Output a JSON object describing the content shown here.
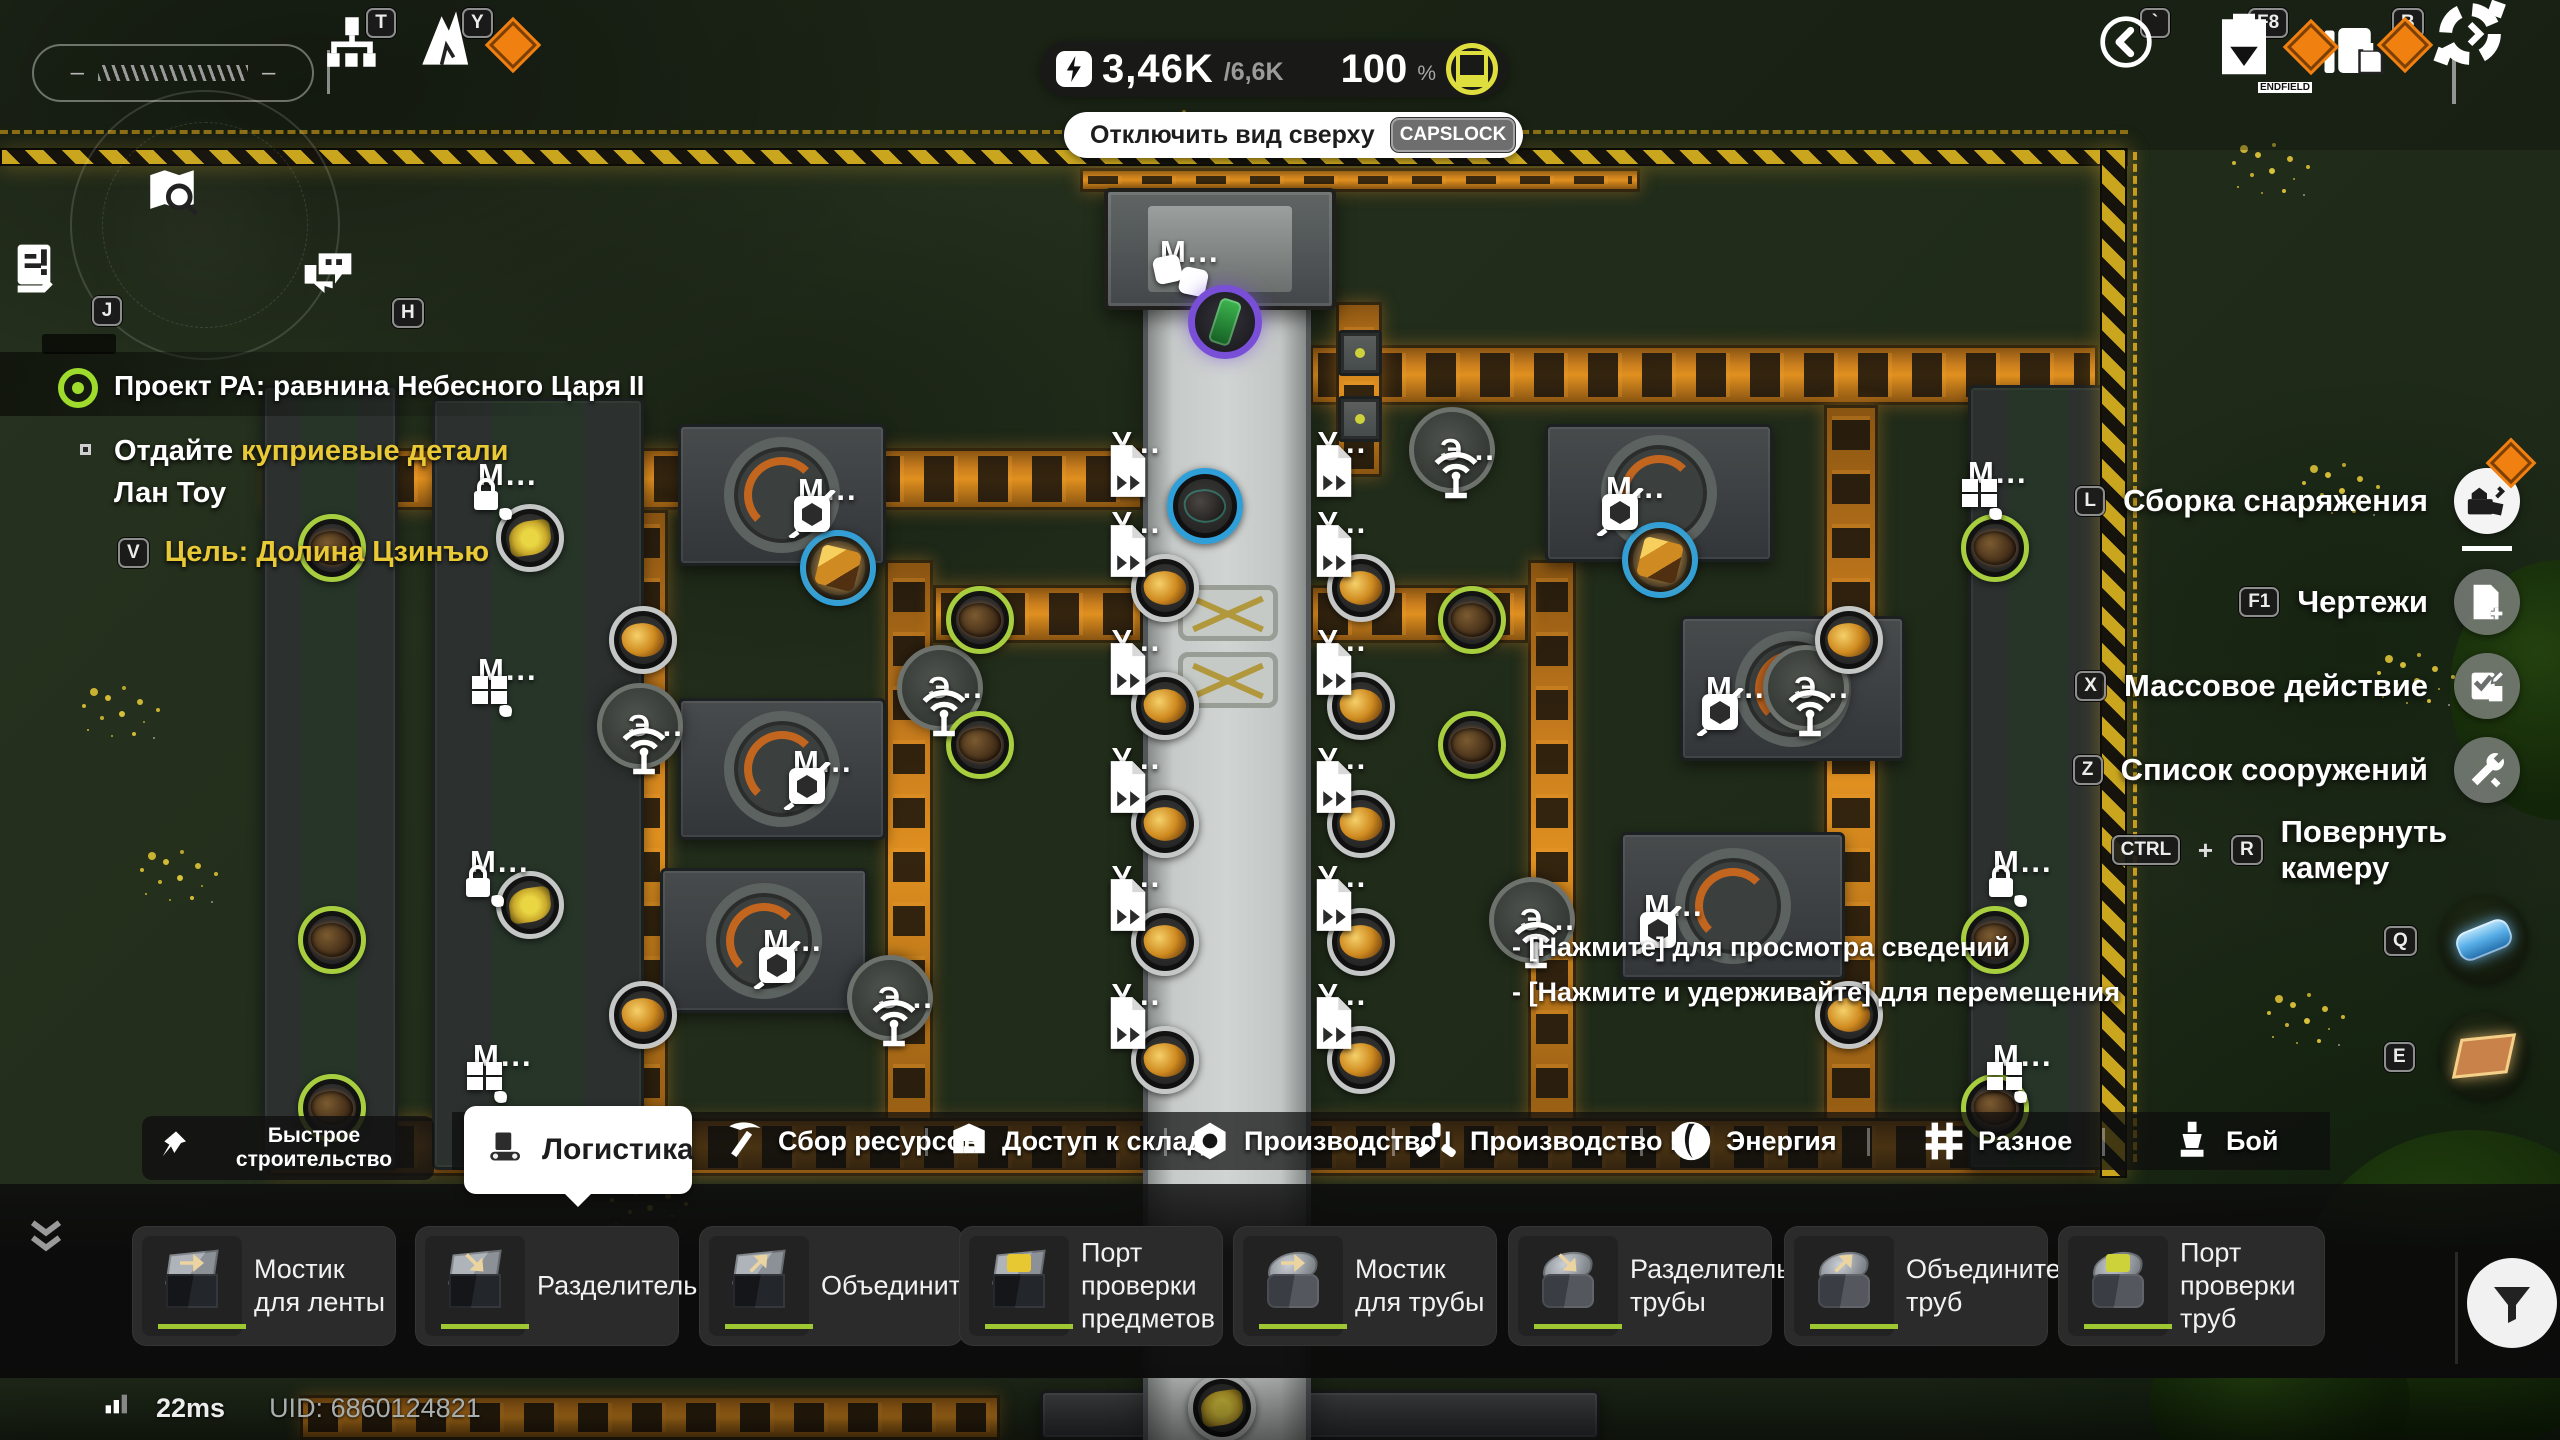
{
  "hud": {
    "gauge": {
      "left_dash": "–",
      "right_dash": "–"
    },
    "top_left_keys": [
      {
        "key": "T",
        "icon": "tech-tree-icon"
      },
      {
        "key": "Y",
        "icon": "upgrade-icon",
        "badge": true
      }
    ],
    "power": {
      "current": "3,46K",
      "max": "/6,6K",
      "percent": "100",
      "unit": "%"
    },
    "top_view": {
      "label": "Отключить вид сверху",
      "key": "CAPSLOCK"
    },
    "top_right_keys": [
      {
        "key": "`",
        "icon": "back-icon"
      },
      {
        "key": "F8",
        "icon": "blueprint-icon",
        "badge": true,
        "icon_text": "ENDFIELD"
      },
      {
        "key": "B",
        "icon": "bag-icon",
        "badge": true
      },
      {
        "icon": "build-mode-icon"
      }
    ]
  },
  "left_icons": [
    {
      "key": "J",
      "icon": "log-icon"
    },
    {
      "key": "H",
      "icon": "chat-icon"
    }
  ],
  "mission": {
    "title": "Проект РА: равнина Небесного Царя II",
    "objective_white": "Отдайте",
    "objective_yellow": " куприевые детали",
    "objective_line2": "Лан Тоу",
    "goal_key": "V",
    "goal": "Цель: Долина Цзинъю"
  },
  "right_menu": [
    {
      "key": "L",
      "label": "Сборка снаряжения",
      "icon": "assemble-icon",
      "badge": true
    },
    {
      "key": "F1",
      "label": "Чертежи",
      "icon": "blueprint-add-icon"
    },
    {
      "key": "X",
      "label": "Массовое действие",
      "icon": "mass-action-icon"
    },
    {
      "key": "Z",
      "label": "Список сооружений",
      "icon": "structure-list-icon"
    },
    {
      "key": "CTRL",
      "plus": "+",
      "key2": "R",
      "label": "Повернуть камеру"
    }
  ],
  "quick_slots": [
    {
      "key": "Q",
      "item": "battery-cell-item"
    },
    {
      "key": "E",
      "item": "foundation-item"
    }
  ],
  "tooltip": {
    "line1": "- [Нажмите] для просмотра сведений",
    "line2": "- [Нажмите и удерживайте] для перемещения"
  },
  "category_bar": {
    "quick_build": {
      "line1": "Быстрое",
      "line2": "строительство"
    },
    "tabs": [
      {
        "label": "Логистика",
        "icon": "conveyor-icon",
        "selected": true
      },
      {
        "label": "Сбор ресурсов",
        "icon": "pickaxe-icon"
      },
      {
        "label": "Доступ к складу",
        "icon": "warehouse-icon"
      },
      {
        "label": "Производство I",
        "icon": "production1-icon"
      },
      {
        "label": "Производство II",
        "icon": "production2-icon"
      },
      {
        "label": "Энергия",
        "icon": "energy-icon"
      },
      {
        "label": "Разное",
        "icon": "misc-icon"
      },
      {
        "label": "Бой",
        "icon": "combat-icon"
      }
    ]
  },
  "build_bar": {
    "items": [
      {
        "label": "Мостик для ленты"
      },
      {
        "label": "Разделитель"
      },
      {
        "label": "Объединитель"
      },
      {
        "label": "Порт проверки предметов"
      },
      {
        "label": "Мостик для трубы"
      },
      {
        "label": "Разделитель трубы"
      },
      {
        "label": "Объединитель труб"
      },
      {
        "label": "Порт проверки труб"
      }
    ]
  },
  "status": {
    "ping": "22ms",
    "uid": "UID: 6860124821"
  },
  "world": {
    "labels": [
      {
        "t": "М...",
        "i": "cube2-icon",
        "x": 1150,
        "y": 252
      },
      {
        "t": "У...",
        "i": "udoc-icon",
        "x": 1102,
        "y": 443
      },
      {
        "t": "У...",
        "i": "udoc-icon",
        "x": 1102,
        "y": 523
      },
      {
        "t": "У...",
        "i": "udoc-icon",
        "x": 1102,
        "y": 641
      },
      {
        "t": "У...",
        "i": "udoc-icon",
        "x": 1102,
        "y": 759
      },
      {
        "t": "У...",
        "i": "udoc-icon",
        "x": 1102,
        "y": 877
      },
      {
        "t": "У...",
        "i": "udoc-icon",
        "x": 1102,
        "y": 995
      },
      {
        "t": "У...",
        "i": "udoc-icon",
        "x": 1308,
        "y": 443
      },
      {
        "t": "У...",
        "i": "udoc-icon",
        "x": 1308,
        "y": 523
      },
      {
        "t": "У...",
        "i": "udoc-icon",
        "x": 1308,
        "y": 641
      },
      {
        "t": "У...",
        "i": "udoc-icon",
        "x": 1308,
        "y": 759
      },
      {
        "t": "У...",
        "i": "udoc-icon",
        "x": 1308,
        "y": 877
      },
      {
        "t": "У...",
        "i": "udoc-icon",
        "x": 1308,
        "y": 995
      },
      {
        "t": "М...",
        "i": "lockleaf-icon",
        "x": 468,
        "y": 475
      },
      {
        "t": "М...",
        "i": "mill-icon",
        "x": 468,
        "y": 670
      },
      {
        "t": "М...",
        "i": "lockleaf-icon",
        "x": 460,
        "y": 862
      },
      {
        "t": "М...",
        "i": "mill-icon",
        "x": 463,
        "y": 1056
      },
      {
        "t": "М...",
        "i": "cube-icon",
        "x": 788,
        "y": 490
      },
      {
        "t": "М...",
        "i": "cube-icon",
        "x": 783,
        "y": 762
      },
      {
        "t": "М...",
        "i": "cube-icon",
        "x": 753,
        "y": 941
      },
      {
        "t": "М...",
        "i": "cube-icon",
        "x": 1596,
        "y": 488
      },
      {
        "t": "М...",
        "i": "cube-icon",
        "x": 1696,
        "y": 688
      },
      {
        "t": "М...",
        "i": "cube-icon",
        "x": 1634,
        "y": 906
      },
      {
        "t": "М...",
        "i": "mill-icon",
        "x": 1958,
        "y": 473
      },
      {
        "t": "М...",
        "i": "lockleaf-icon",
        "x": 1983,
        "y": 862
      },
      {
        "t": "М...",
        "i": "mill-icon",
        "x": 1983,
        "y": 1056
      },
      {
        "t": "Э...",
        "i": "eradio-icon",
        "x": 618,
        "y": 726
      },
      {
        "t": "Э...",
        "i": "eradio-icon",
        "x": 918,
        "y": 688
      },
      {
        "t": "Э...",
        "i": "eradio-icon",
        "x": 1430,
        "y": 450
      },
      {
        "t": "Э...",
        "i": "eradio-icon",
        "x": 1784,
        "y": 688
      },
      {
        "t": "Э...",
        "i": "eradio-icon",
        "x": 868,
        "y": 998
      },
      {
        "t": "Э...",
        "i": "eradio-icon",
        "x": 1510,
        "y": 920
      }
    ],
    "ores": [
      {
        "x": 1205,
        "y": 506,
        "r": "b",
        "f": "rock"
      },
      {
        "x": 1660,
        "y": 560,
        "r": "b",
        "f": "goldcube"
      },
      {
        "x": 838,
        "y": 568,
        "r": "b",
        "f": "goldcube"
      },
      {
        "x": 1165,
        "y": 588,
        "r": "k",
        "f": "gold"
      },
      {
        "x": 1165,
        "y": 706,
        "r": "k",
        "f": "gold"
      },
      {
        "x": 1165,
        "y": 824,
        "r": "k",
        "f": "gold"
      },
      {
        "x": 1165,
        "y": 942,
        "r": "k",
        "f": "gold"
      },
      {
        "x": 1165,
        "y": 1060,
        "r": "k",
        "f": "gold"
      },
      {
        "x": 1361,
        "y": 588,
        "r": "k",
        "f": "gold"
      },
      {
        "x": 1361,
        "y": 706,
        "r": "k",
        "f": "gold"
      },
      {
        "x": 1361,
        "y": 824,
        "r": "k",
        "f": "gold"
      },
      {
        "x": 1361,
        "y": 942,
        "r": "k",
        "f": "gold"
      },
      {
        "x": 1361,
        "y": 1060,
        "r": "k",
        "f": "gold"
      },
      {
        "x": 643,
        "y": 640,
        "r": "k",
        "f": "gold"
      },
      {
        "x": 643,
        "y": 1015,
        "r": "k",
        "f": "gold"
      },
      {
        "x": 1849,
        "y": 640,
        "r": "k",
        "f": "gold"
      },
      {
        "x": 1849,
        "y": 1015,
        "r": "k",
        "f": "gold"
      },
      {
        "x": 332,
        "y": 548,
        "r": "g",
        "f": "brown"
      },
      {
        "x": 332,
        "y": 940,
        "r": "g",
        "f": "brown"
      },
      {
        "x": 332,
        "y": 1108,
        "r": "g",
        "f": "brown"
      },
      {
        "x": 1995,
        "y": 548,
        "r": "g",
        "f": "brown"
      },
      {
        "x": 1995,
        "y": 940,
        "r": "g",
        "f": "brown"
      },
      {
        "x": 1995,
        "y": 1108,
        "r": "g",
        "f": "brown"
      },
      {
        "x": 980,
        "y": 620,
        "r": "g",
        "f": "brown"
      },
      {
        "x": 980,
        "y": 745,
        "r": "g",
        "f": "brown"
      },
      {
        "x": 1472,
        "y": 620,
        "r": "g",
        "f": "brown"
      },
      {
        "x": 1472,
        "y": 745,
        "r": "g",
        "f": "brown"
      },
      {
        "x": 530,
        "y": 538,
        "r": "k",
        "f": "flower"
      },
      {
        "x": 530,
        "y": 905,
        "r": "k",
        "f": "flower"
      },
      {
        "x": 1222,
        "y": 1408,
        "r": "k",
        "f": "flower"
      }
    ],
    "belts": [
      {
        "x": 1080,
        "y": 168,
        "w": 560,
        "h": 24,
        "o": "h"
      },
      {
        "x": 268,
        "y": 448,
        "w": 875,
        "h": 62,
        "o": "h"
      },
      {
        "x": 1310,
        "y": 345,
        "w": 788,
        "h": 60,
        "o": "h"
      },
      {
        "x": 1336,
        "y": 302,
        "w": 46,
        "h": 175,
        "o": "v"
      },
      {
        "x": 612,
        "y": 510,
        "w": 56,
        "h": 650,
        "o": "v"
      },
      {
        "x": 885,
        "y": 560,
        "w": 48,
        "h": 600,
        "o": "v"
      },
      {
        "x": 1528,
        "y": 560,
        "w": 48,
        "h": 600,
        "o": "v"
      },
      {
        "x": 1824,
        "y": 405,
        "w": 54,
        "h": 755,
        "o": "v"
      },
      {
        "x": 1310,
        "y": 585,
        "w": 218,
        "h": 58,
        "o": "h"
      },
      {
        "x": 933,
        "y": 585,
        "w": 210,
        "h": 58,
        "o": "h"
      },
      {
        "x": 268,
        "y": 1118,
        "w": 1830,
        "h": 58,
        "o": "h"
      },
      {
        "x": 300,
        "y": 1395,
        "w": 700,
        "h": 45,
        "o": "h"
      }
    ],
    "machines": [
      {
        "x": 262,
        "y": 385,
        "w": 136,
        "h": 785,
        "k": "green"
      },
      {
        "x": 432,
        "y": 398,
        "w": 212,
        "h": 772,
        "k": "green"
      },
      {
        "x": 678,
        "y": 424,
        "w": 208,
        "h": 142,
        "k": "smelt"
      },
      {
        "x": 678,
        "y": 698,
        "w": 208,
        "h": 142,
        "k": "smelt"
      },
      {
        "x": 660,
        "y": 868,
        "w": 208,
        "h": 145,
        "k": "smelt"
      },
      {
        "x": 1545,
        "y": 424,
        "w": 228,
        "h": 138,
        "k": "smelt"
      },
      {
        "x": 1680,
        "y": 616,
        "w": 225,
        "h": 145,
        "k": "smelt"
      },
      {
        "x": 1620,
        "y": 832,
        "w": 225,
        "h": 148,
        "k": "smelt"
      },
      {
        "x": 1968,
        "y": 385,
        "w": 140,
        "h": 785,
        "k": "green"
      },
      {
        "x": 1040,
        "y": 1390,
        "w": 560,
        "h": 50,
        "k": "plain"
      },
      {
        "x": 1338,
        "y": 330,
        "w": 44,
        "h": 46,
        "k": "dev"
      },
      {
        "x": 1338,
        "y": 396,
        "w": 44,
        "h": 46,
        "k": "dev"
      }
    ],
    "power_nodes": [
      {
        "x": 640,
        "y": 726
      },
      {
        "x": 940,
        "y": 688
      },
      {
        "x": 1452,
        "y": 450
      },
      {
        "x": 1806,
        "y": 688
      },
      {
        "x": 890,
        "y": 998
      },
      {
        "x": 1532,
        "y": 920
      }
    ],
    "bus": {
      "x": 1143,
      "y": 298,
      "w": 168,
      "h": 1142
    },
    "xplates": [
      {
        "x": 1178,
        "y": 585,
        "w": 100,
        "h": 56
      },
      {
        "x": 1178,
        "y": 652,
        "w": 100,
        "h": 56
      }
    ],
    "top_machine": {
      "x": 1104,
      "y": 188,
      "w": 232,
      "h": 122
    },
    "hazards": [
      {
        "x": 0,
        "y": 148,
        "w": 2128,
        "h": 18
      },
      {
        "x": 2100,
        "y": 148,
        "w": 27,
        "h": 1030
      }
    ],
    "dashes": [
      {
        "x": 0,
        "y": 130,
        "w": 2128,
        "h": 4,
        "o": "h"
      },
      {
        "x": 2133,
        "y": 152,
        "w": 4,
        "h": 1010,
        "o": "v"
      }
    ],
    "player": {
      "x": 1225,
      "y": 322
    },
    "flowers": [
      {
        "x": 1150,
        "y": 112
      },
      {
        "x": 2240,
        "y": 145
      },
      {
        "x": 2310,
        "y": 465
      },
      {
        "x": 2385,
        "y": 655
      },
      {
        "x": 90,
        "y": 688
      },
      {
        "x": 148,
        "y": 852
      },
      {
        "x": 618,
        "y": 1182
      },
      {
        "x": 2275,
        "y": 995
      }
    ],
    "trees": [
      {
        "x": 2300,
        "y": 1130,
        "w": 340,
        "h": 320
      },
      {
        "x": 2450,
        "y": 560,
        "w": 220,
        "h": 260
      },
      {
        "x": 2150,
        "y": 1310,
        "w": 260,
        "h": 180
      }
    ]
  }
}
